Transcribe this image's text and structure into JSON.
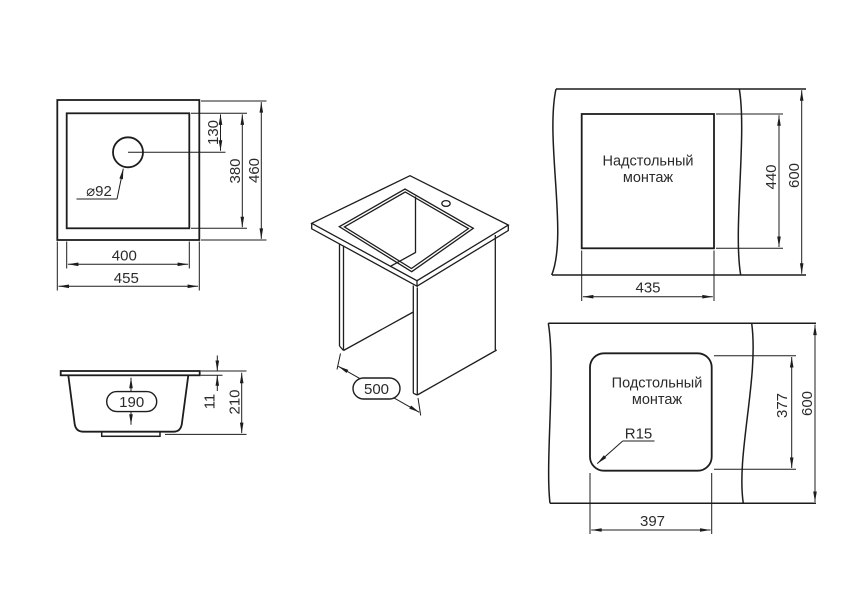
{
  "colors": {
    "background": "#ffffff",
    "line": "#1d1d1d",
    "text": "#2b2b2b"
  },
  "views": {
    "top": {
      "hole_diameter": "⌀92",
      "hole_offset": "130",
      "bowl_height": "380",
      "outer_height": "460",
      "bowl_width": "400",
      "outer_width": "455"
    },
    "side": {
      "bowl_depth": "190",
      "rim_thickness": "11",
      "total_height": "210"
    },
    "iso": {
      "cabinet_depth": "500"
    },
    "overmount": {
      "title_line1": "Надстольный",
      "title_line2": "монтаж",
      "cutout_width": "435",
      "cutout_height": "440",
      "counter_depth": "600"
    },
    "undermount": {
      "title_line1": "Подстольный",
      "title_line2": "монтаж",
      "cutout_width": "397",
      "cutout_height": "377",
      "counter_depth": "600",
      "corner_radius": "R15"
    }
  }
}
